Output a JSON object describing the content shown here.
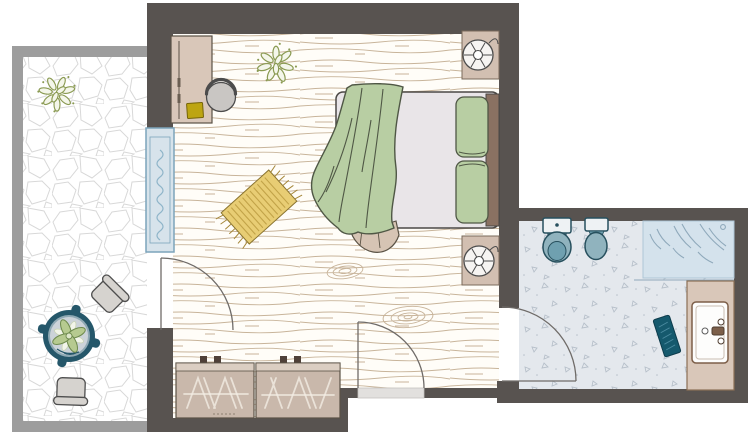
{
  "diagram": {
    "type": "floor-plan",
    "rooms": [
      {
        "name": "bedroom",
        "floor": "wood-plank",
        "openings": [
          "window",
          "patio-door",
          "entrance-door",
          "bathroom-door"
        ]
      },
      {
        "name": "bathroom",
        "floor": "speckled-tile"
      },
      {
        "name": "patio",
        "floor": "flagstone"
      }
    ],
    "furniture": {
      "bedroom": [
        "desk",
        "desk-chair",
        "laptop",
        "plant",
        "striped-rug",
        "double-bed",
        "blanket",
        "pillow",
        "pillow",
        "nightstand",
        "table-fan",
        "nightstand",
        "table-fan",
        "dresser"
      ],
      "bathroom": [
        "toilet",
        "bidet",
        "shower",
        "vanity-sink",
        "bath-mat"
      ],
      "patio": [
        "plant",
        "round-table",
        "potted-plant",
        "chair",
        "chair"
      ]
    }
  },
  "colors": {
    "c-wall": "#585350",
    "c-patio-wall": "#9d9d9d",
    "c-wood-line": "#c8b49a",
    "c-stone-line": "#d8d8d8",
    "c-bed-floor": "#fffdf8",
    "c-bath-floor": "#e4e8ed",
    "c-speckle": "#b7c0ca",
    "c-outline": "#4b4845",
    "c-door": "#6f6b68",
    "c-threshold": "#e2e0de",
    "c-tan": "#d9c7b9",
    "c-tan-mid": "#d2bfb1",
    "c-tan-dark": "#c9b8ab",
    "c-tan-top": "#dbcec2",
    "c-knob": "#4f4038",
    "c-yellow": "#bda512",
    "c-rug": "#e8cd74",
    "c-rug-stripe": "#c2a348",
    "c-rug-fringe": "#a5873a",
    "c-mattress": "#e9e5e8",
    "c-headboard": "#8a7162",
    "c-beige": "#d6c4b4",
    "c-green": "#b8cea3",
    "c-green-line": "#4f5745",
    "c-teal": "#90b3be",
    "c-teal-dark": "#27505e",
    "c-teal-inner": "#6fa0b0",
    "c-fixture": "#eef2f4",
    "c-mat": "#15596d",
    "c-mat-line": "#4b8ba0",
    "c-shower": "#d4e2ec",
    "c-shower-line": "#8fa9bb",
    "c-window": "#d7e3eb",
    "c-window-frame": "#7ca4bb",
    "c-curtain": "#8fb5c9",
    "c-chair": "#d6d3cf",
    "c-gray-item": "#c9c6c3",
    "c-white-item": "#f6f4f2",
    "c-table-ring": "#25576a",
    "c-table-mid": "#8fa9b4",
    "c-table-top": "#ccd3d9",
    "c-leaf": "#b6ca90",
    "c-leaf-dark": "#6e8a4e",
    "c-plant": "#8a9a52",
    "c-vanity-line": "#8a6f55"
  }
}
